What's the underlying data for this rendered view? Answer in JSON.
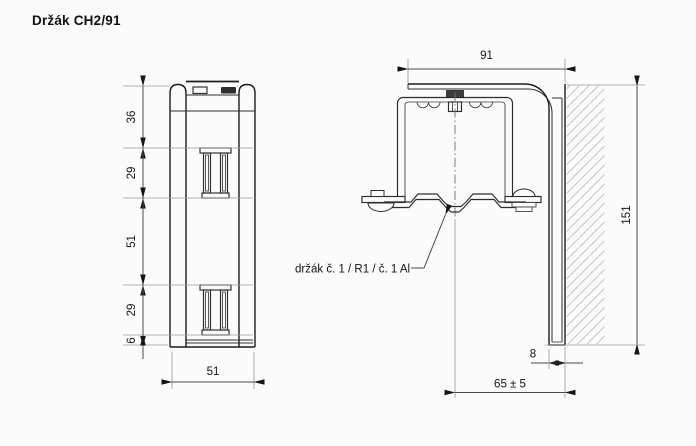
{
  "title": "Držák CH2/91",
  "colors": {
    "ink": "#1c1c1c",
    "extension_line": "#9b9b9b",
    "hatch": "#c6c6c6"
  },
  "front_view": {
    "height_dims": [
      "36",
      "29",
      "51",
      "29",
      "6"
    ],
    "width_dim": "51"
  },
  "side_view": {
    "top_dim": "91",
    "height_dim": "151",
    "leg_thickness_dim": "8",
    "offset_dim": "65 ± 5",
    "callout": "držák č. 1 / R1 / č. 1 Al"
  }
}
